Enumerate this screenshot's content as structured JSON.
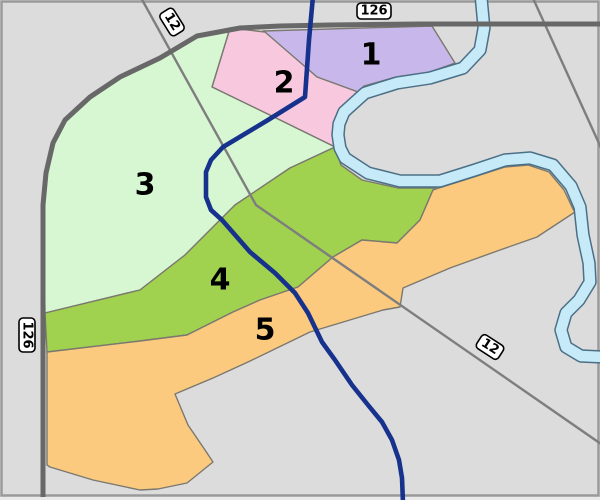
{
  "map": {
    "background": "#dcdcdc",
    "outside_color": "#e9e9e9",
    "frame_color": "#9a9a9a",
    "region_stroke": "#7b786f",
    "road_thick_color": "#686868",
    "road_thin_color": "#7e7e7e",
    "route_line_color": "#16328c",
    "river": {
      "fill": "#c6eaf8",
      "outline": "#4b7086",
      "points": "481,-4 484,28 480,50 463,68 430,78 397,83 365,93 344,112 339,124 338,135 340,148 345,158 368,173 400,181 440,181 475,170 505,160 530,158 553,165 571,186 580,207 583,235 589,263 590,282 579,300 566,313 561,330 566,347 581,356 604,357"
    },
    "regions": [
      {
        "label": "1",
        "color": "#c8b7ea",
        "label_x": 371,
        "label_y": 55,
        "points": "263,31 432,26 455,63 430,72 396,77 364,86 358,92 317,77"
      },
      {
        "label": "2",
        "color": "#f8c8df",
        "label_x": 284,
        "label_y": 83,
        "points": "230,28 265,32 317,77 358,92 340,110 332,135 335,147 280,120 212,87"
      },
      {
        "label": "3",
        "color": "#d7f7d3",
        "label_x": 145,
        "label_y": 185,
        "points": "230,28 212,87 280,120 335,147 290,168 235,205 185,255 140,290 45,313 44,250 43,205 46,173 53,143 65,120 90,97 120,77 160,58 197,36"
      },
      {
        "label": "4",
        "color": "#a0d14f",
        "label_x": 220,
        "label_y": 280,
        "points": "45,313 140,290 185,255 235,205 290,168 335,147 341,165 362,180 398,188 436,188 433,190 420,220 397,243 362,240 333,257 298,287 260,300 233,312 187,335 140,341 47,352"
      },
      {
        "label": "5",
        "color": "#fbca7e",
        "label_x": 265,
        "label_y": 330,
        "points": "47,352 140,341 187,335 233,312 260,300 298,287 333,257 362,240 397,243 420,220 433,190 439,188 474,177 505,167 528,165 549,172 564,190 573,209 575,212 537,237 500,250 450,268 403,288 400,307 383,310 310,332 248,362 213,378 175,394 188,425 205,450 213,462 187,483 158,489 140,490 93,480 50,467 47,465"
      }
    ],
    "roads": [
      {
        "name": "road-126-main",
        "kind": "thick",
        "d": "M 604,24 L 420,24 L 330,25 L 280,26 L 240,28 L 197,36 L 160,58 L 120,77 L 90,97 L 65,120 L 53,143 L 46,173 L 43,205 L 43,497"
      },
      {
        "name": "road-12",
        "kind": "thin",
        "d": "M 140,-4 L 256,205 L 604,446"
      },
      {
        "name": "road-northeast",
        "kind": "thin",
        "d": "M 532,-4 L 602,150"
      }
    ],
    "route_line": {
      "points": "313,-4 309,40 305,97 268,120 223,147 211,160 206,172 206,197 211,210 222,220 250,252 275,273 295,293 308,313 322,342 335,360 352,385 368,405 382,422 392,440 399,460 402,478 403,503"
    },
    "shields": [
      {
        "text": "12",
        "x": 172,
        "y": 22,
        "rotate": 58,
        "w": 26,
        "h": 16
      },
      {
        "text": "126",
        "x": 374,
        "y": 11,
        "rotate": 0,
        "w": 34,
        "h": 16
      },
      {
        "text": "126",
        "x": 27,
        "y": 335,
        "rotate": 90,
        "w": 34,
        "h": 16
      },
      {
        "text": "12",
        "x": 490,
        "y": 347,
        "rotate": 33,
        "w": 26,
        "h": 16
      }
    ]
  }
}
